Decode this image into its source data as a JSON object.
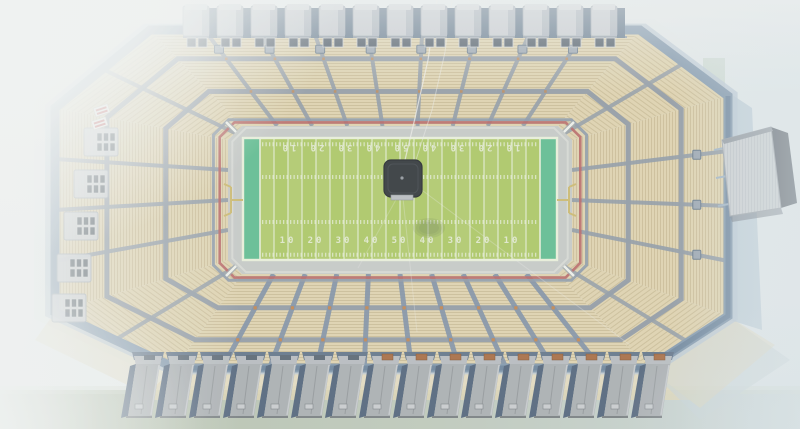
{
  "field": {
    "yard_numbers": [
      "10",
      "20",
      "30",
      "40",
      "50",
      "40",
      "30",
      "20",
      "10"
    ],
    "colors": {
      "turf": "#a9c45f",
      "turf_light": "#ffffff",
      "endzone": "#5cb98c",
      "lines": "#e7edd8",
      "numbers": "#e3e9d3",
      "ring_walkway": "#c3c6c3",
      "ring_red": "#b55f5f",
      "ring_edge_blue": "#8795a5",
      "ring_inner_white": "#d8dad4",
      "goalpost": "#c9b66a"
    }
  },
  "stadium": {
    "colors": {
      "seats": "#ddd0ab",
      "seat_stripe": "#c2b189",
      "aisle_gray": "#8d97a2",
      "aisle_blue": "#7b8ca2",
      "ring_line": "#8b95a0",
      "rim": "#7e94a9",
      "rim_light": "#b8c6d2",
      "apron_tan": "#e0d3ae",
      "apron_blue": "#c3ced2",
      "wall_dark": "#5c7186",
      "vomitory": "#98a2ad",
      "section_marker": "#c8803f"
    },
    "jumbotron": {
      "body": "#2c3034",
      "edge": "#1e2226",
      "base": "#b7babd",
      "dot": "#90959a",
      "shadow": "#5c6c48"
    },
    "scoreboard": {
      "screen": "#c8ccce",
      "frame": "#575e66",
      "trim": "#8e959c",
      "support": "#9db0c0"
    },
    "roof_boxes": {
      "count": 13,
      "fill": "#c5c9ce",
      "cap": "#d3d6da",
      "shade": "#aab2bb",
      "gap": "#5c7186",
      "window": "#46525f",
      "window_frame": "#ccd0d3"
    },
    "side_boxes": {
      "count": 5,
      "fill": "#c9ccd0",
      "window": "#3e4a56",
      "window_frame": "#d0d3d6"
    },
    "gates": {
      "count": 16,
      "face": "#a7abae",
      "shadow_side": "#4d5f76",
      "roof": "#b4b8bc",
      "roof_dark": "#5e7085",
      "door": "#a4673d",
      "plaque": "#c6c9cb",
      "highlight": "#c3c6c9"
    },
    "kiosk": {
      "body": "#f2f1ee",
      "stripe": "#c04848"
    }
  },
  "environment": {
    "sky_fog": "#eef0ef",
    "ground_grass_left": "#b2bda7",
    "ground_grass_right": "#c8d3d4",
    "cable": "#ecebe7"
  }
}
